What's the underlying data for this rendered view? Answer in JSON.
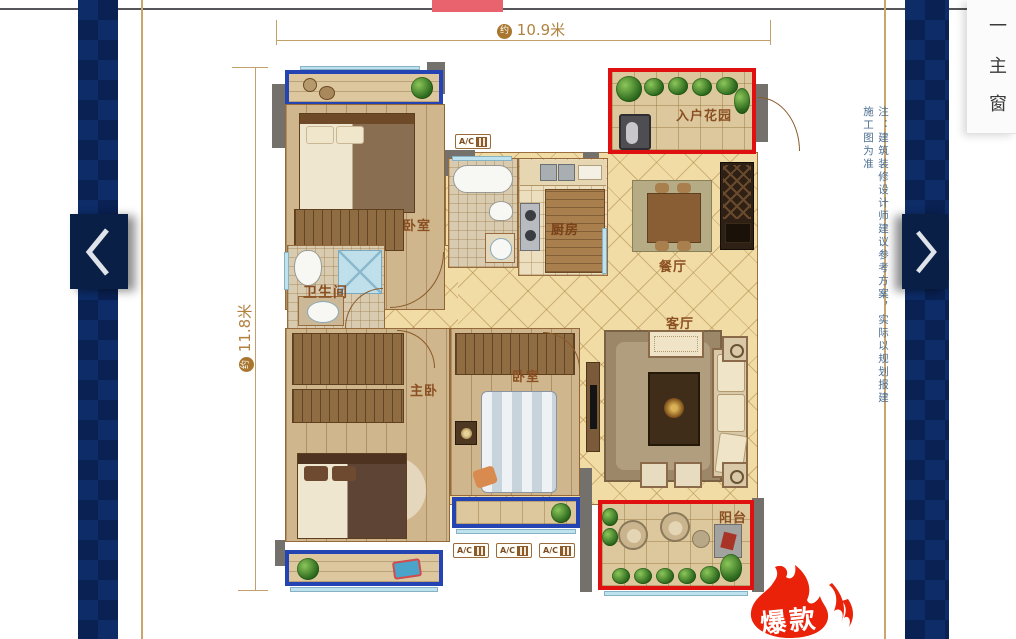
{
  "header": {
    "active_tab_color": "#e8636e"
  },
  "nav": {
    "prev_icon": "chevron-left",
    "next_icon": "chevron-right"
  },
  "info_panel": {
    "items": [
      "一",
      "主",
      "窗"
    ]
  },
  "floorplan": {
    "dim_width_prefix": "约",
    "dim_width": "10.9米",
    "dim_height_prefix": "约",
    "dim_height": "11.8米",
    "rooms": {
      "bedroom_top": "卧室",
      "bathroom": "卫生间",
      "master_bedroom": "主卧",
      "bedroom_mid": "卧室",
      "kitchen": "厨房",
      "entry_garden": "入户花园",
      "dining_room": "餐厅",
      "living_room": "客厅",
      "balcony": "阳台"
    },
    "ac_label": "A/C",
    "note": "注：建筑装修设计师建议参考方案，实际以规划报建施工图为准",
    "badge": "爆款"
  },
  "colors": {
    "band_navy": "#0d2c68",
    "button_navy": "#0a1f46",
    "gold_line": "#c9a76a",
    "dim_text": "#b0823e",
    "room_label": "#8a4f22",
    "note_text": "#4d6e91",
    "highlight_red": "#e01010",
    "highlight_blue": "#2444b4",
    "flame_red": "#e92209",
    "tab_red": "#e8636e"
  }
}
